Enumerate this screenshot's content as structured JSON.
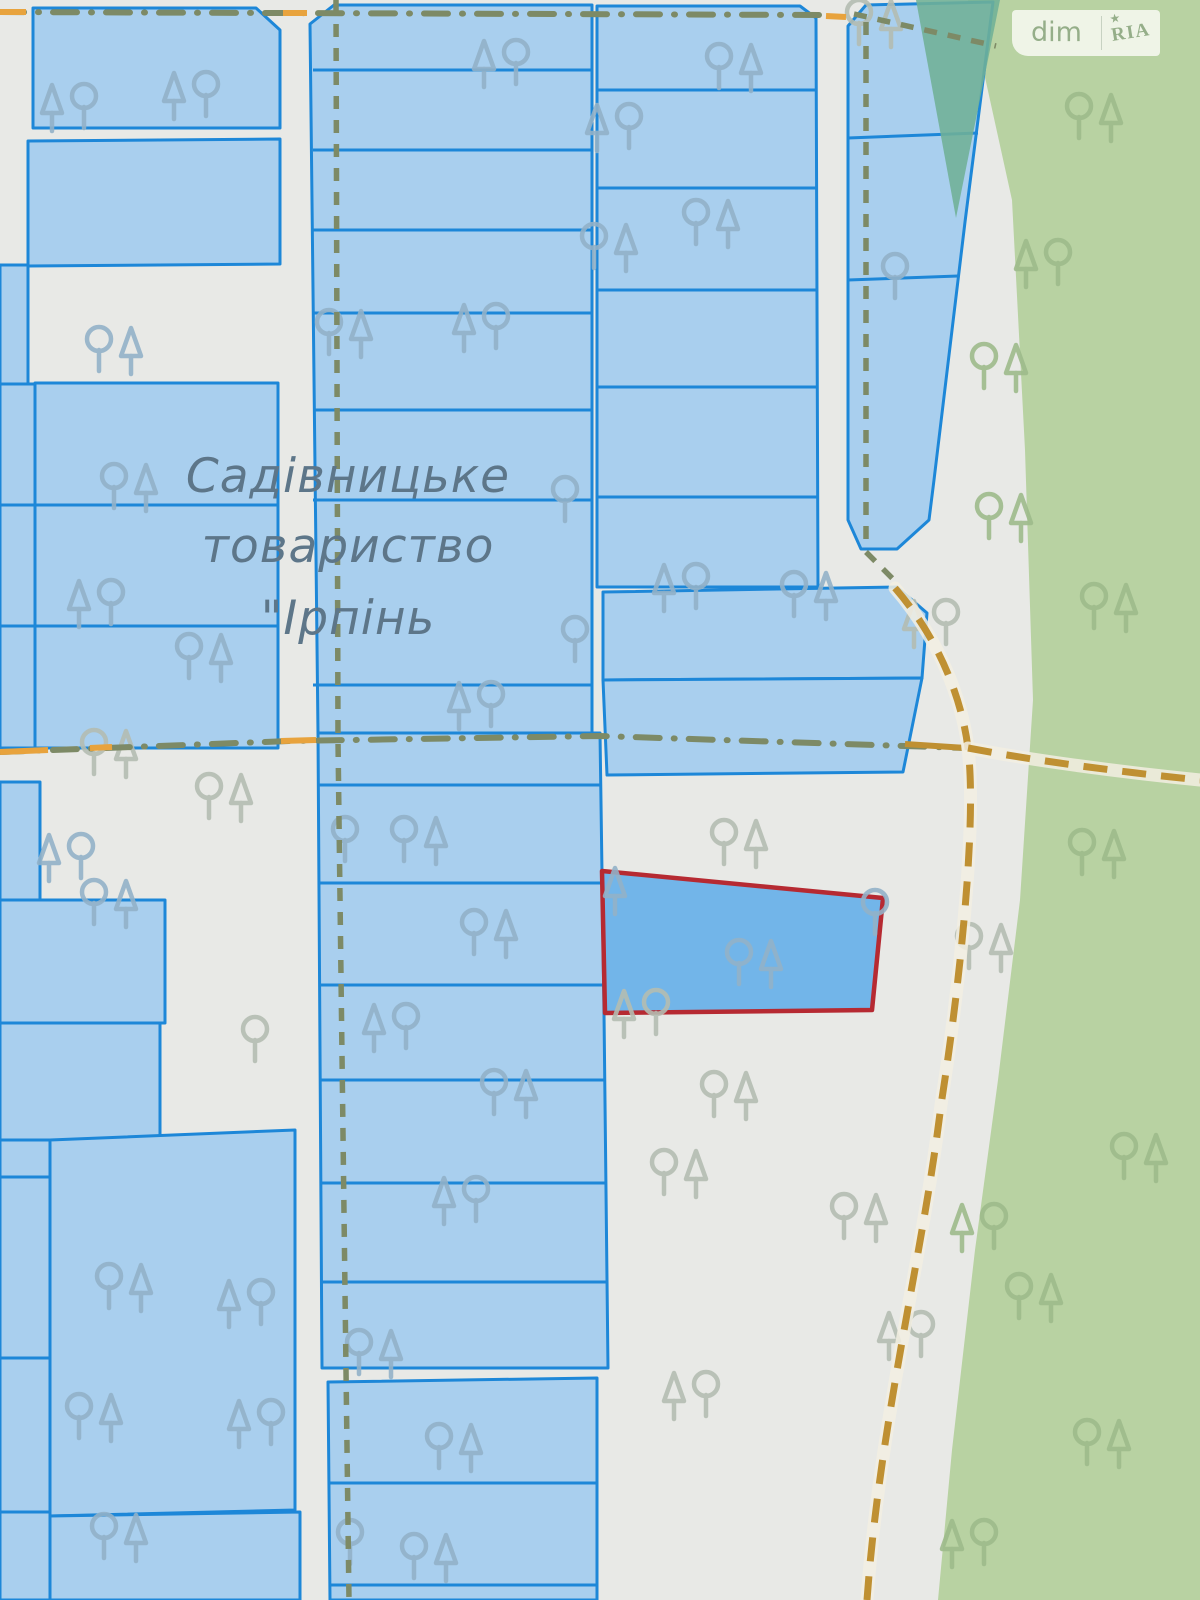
{
  "map": {
    "settlement_label": {
      "line1": "Садівницьке",
      "line2": "товариство",
      "line3": "\"Ірпінь"
    },
    "watermark": {
      "left": "dim",
      "right": "RIA",
      "star": "★"
    },
    "colors": {
      "background": "#e8e9e6",
      "forest": "#b8d2a2",
      "teal_overlay": "#6fb096",
      "parcel_fill": "#a9cfee",
      "parcel_border": "#1d87d8",
      "highlighted_parcel_fill": "#72b5e9",
      "highlighted_parcel_border": "#b62a32",
      "path_olive": "#7d8a66",
      "road_tan": "#bf9032",
      "road_orange": "#e8a33d",
      "label_text": "#5d7689",
      "watermark_green": "#95ae89"
    },
    "icons": {
      "tree_deciduous": "circle-head tree outline",
      "tree_conifer": "triangle-head tree outline"
    },
    "highlighted_parcel": {
      "outline_color": "#b62a32",
      "fill_color": "#72b5e9"
    }
  }
}
